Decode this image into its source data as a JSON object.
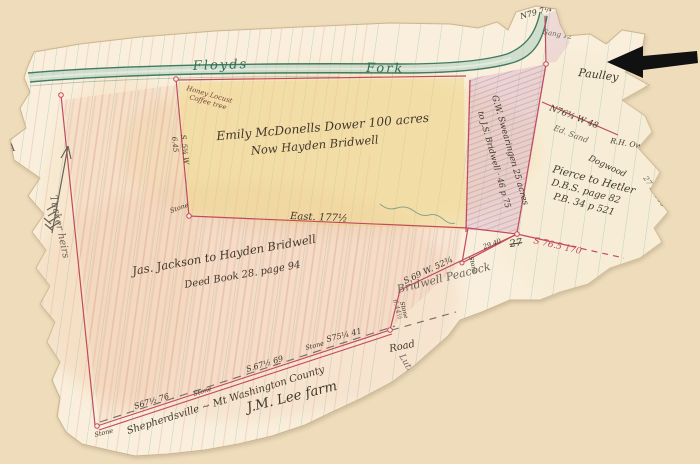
{
  "map": {
    "description": "Hand-drawn land survey plat on ruled ledger paper",
    "colors": {
      "background": "#efdcba",
      "paper": "#f9efdc",
      "survey_line": "#c24a5f",
      "stream_green": "#2f6f58",
      "ink": "#42382c",
      "yellow_parcel": "#eed27f",
      "pink_parcel": "#d2a2c4",
      "annotation_arrow": "#111111"
    },
    "labels": {
      "floyds": "Floyds",
      "fork": "Fork",
      "emily1": "Emily McDonells Dower 100 acres",
      "emily2": "Now Hayden Bridwell",
      "east": "East. 177½",
      "jackson1": "Jas. Jackson to Hayden Bridwell",
      "jackson2": "Deed Book 28. page 94",
      "swearingen1": "G.W. Swearingen 25 acres",
      "swearingen2": "to J.S. Bridwell · 46 p 75",
      "pierce1": "Pierce to Hetler",
      "pierce2": "D.B.S. page 82",
      "pierce3": "P.B. 34 p 521",
      "peacock": "Bridwell Peacock",
      "lee": "J.M. Lee farm",
      "paulley": "Paulley",
      "tucker": "Tucker heirs",
      "road_name": "Shepherdsville ~ Mt Washington County",
      "road_word": "Road",
      "luther": "Luther",
      "s67b": "S67½ 76",
      "s67a": "S.67½ 69",
      "s75": "S75¼ 41",
      "s69": "S.69 W. 52¾",
      "s765": "S 76.5 170",
      "n76": "N76¾ W 48",
      "n79": "N79 7¼",
      "s534": "S. 5¾ W",
      "d645": "6.45",
      "d644": "6.44½",
      "d2940": "29.40",
      "d27": "27",
      "edge1": "27 N 160",
      "edge2": "24 E",
      "stone": "Stone",
      "note1": "Honey Locust",
      "note2": "Coffee tree",
      "sang": "Sang 12",
      "rh_ow": "R.H. Ow",
      "ed_sand": "Ed. Sand",
      "dogwood": "Dogwood",
      "letter_a": "A"
    }
  }
}
